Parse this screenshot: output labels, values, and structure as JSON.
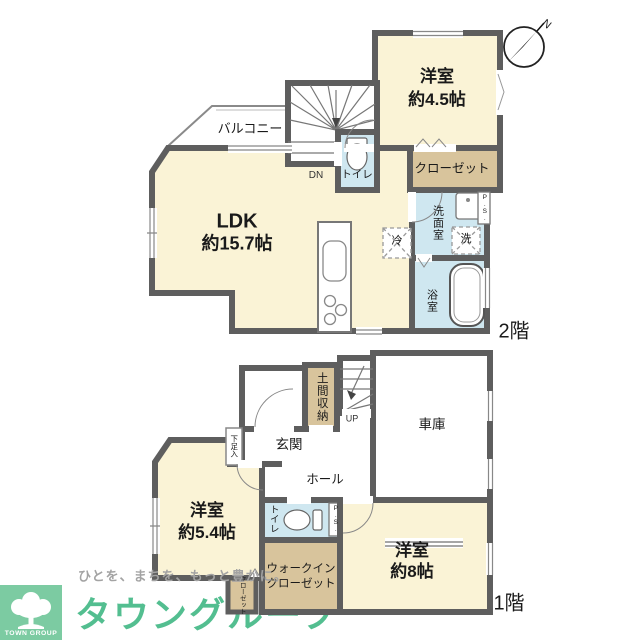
{
  "floors": {
    "second": {
      "floor_label": "2階",
      "ldk": {
        "name": "LDK",
        "size": "約15.7帖"
      },
      "western_room": {
        "name": "洋室",
        "size": "約4.5帖"
      },
      "balcony": "バルコニー",
      "closet": "クローゼット",
      "toilet": "トイレ",
      "washroom": "洗面室",
      "bathroom": "浴室",
      "refrigerator": "冷",
      "washer": "洗",
      "pipe_space": "P.S.",
      "stairs": "DN"
    },
    "first": {
      "floor_label": "1階",
      "entrance": "玄関",
      "doma_storage": "土間収納",
      "shoe_cabinet": "下足入",
      "hall": "ホール",
      "garage": "車庫",
      "western_room_a": {
        "name": "洋室",
        "size": "約5.4帖"
      },
      "western_room_b": {
        "name": "洋室",
        "size": "約8帖"
      },
      "walk_in_closet": {
        "line1": "ウォークイン",
        "line2": "クローゼット"
      },
      "closet": "クローゼット",
      "toilet": "トイレ",
      "pipe_space": "P.S.",
      "stairs": "UP"
    }
  },
  "compass": {
    "north": "N"
  },
  "branding": {
    "logo_text": "TOWN GROUP",
    "tagline": "ひとを、まちを、もっと豊かに。",
    "brand_name": "タウングループ"
  },
  "colors": {
    "wall": "#5E5E5E",
    "room_cream": "#FAF3D6",
    "storage_tan": "#D8C49C",
    "wet_area_blue": "#CFE7F0",
    "logo_green": "#7CCBA2",
    "brand_text_green": "#53BE90",
    "tagline_gray": "#A3A3A3"
  }
}
